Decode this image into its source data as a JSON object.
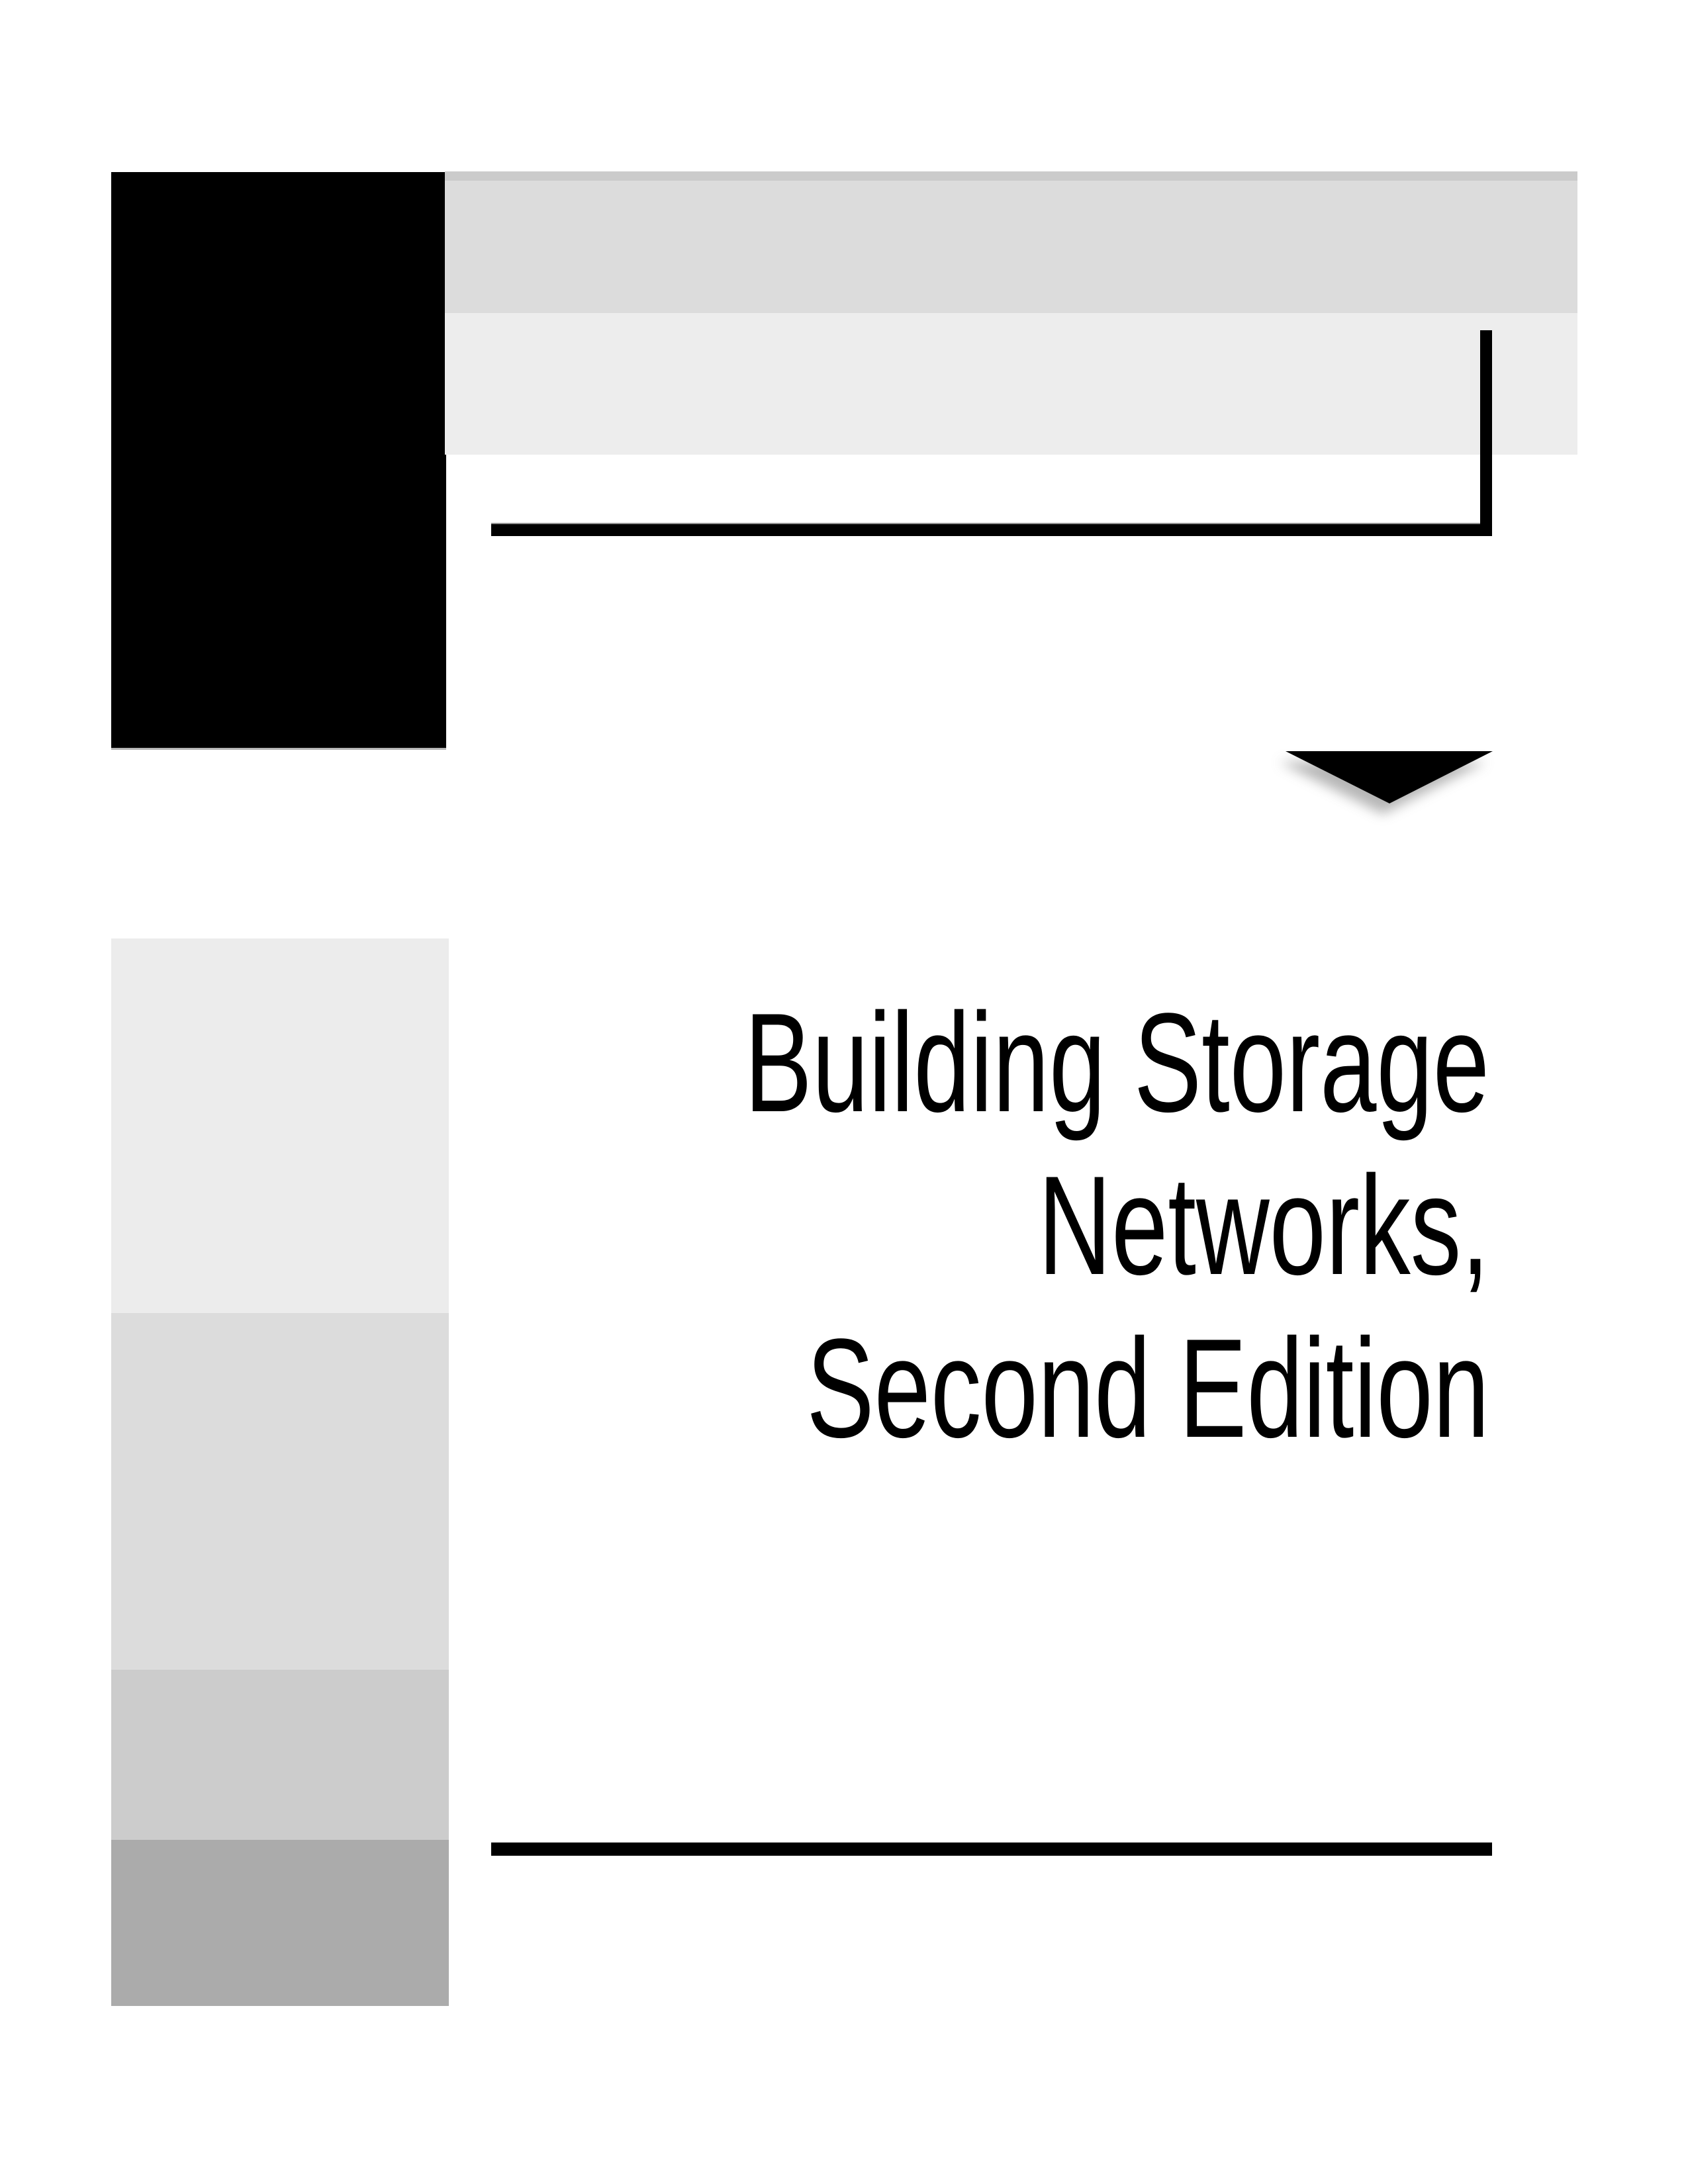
{
  "page": {
    "kind": "book-title-page"
  },
  "title": {
    "lines": [
      "Building Storage",
      "Networks,",
      "Second Edition"
    ]
  },
  "icons": {
    "down_arrow": "filled-triangle-pointing-down-with-drop-shadow",
    "corner_bracket": "black-L-shaped-rule"
  },
  "colors": {
    "black": "#000000",
    "text": "#000000",
    "strip_gray": "#cbcbcb",
    "bar_dark_gray": "#dcdcdc",
    "bar_light_gray": "#ededed",
    "sidebar_block_1": "#ececec",
    "sidebar_block_2": "#dcdcdc",
    "sidebar_block_3": "#cccccc",
    "sidebar_block_4": "#ababab",
    "triangle_shadow": "#9e9e9e",
    "page_background": "#ffffff"
  }
}
